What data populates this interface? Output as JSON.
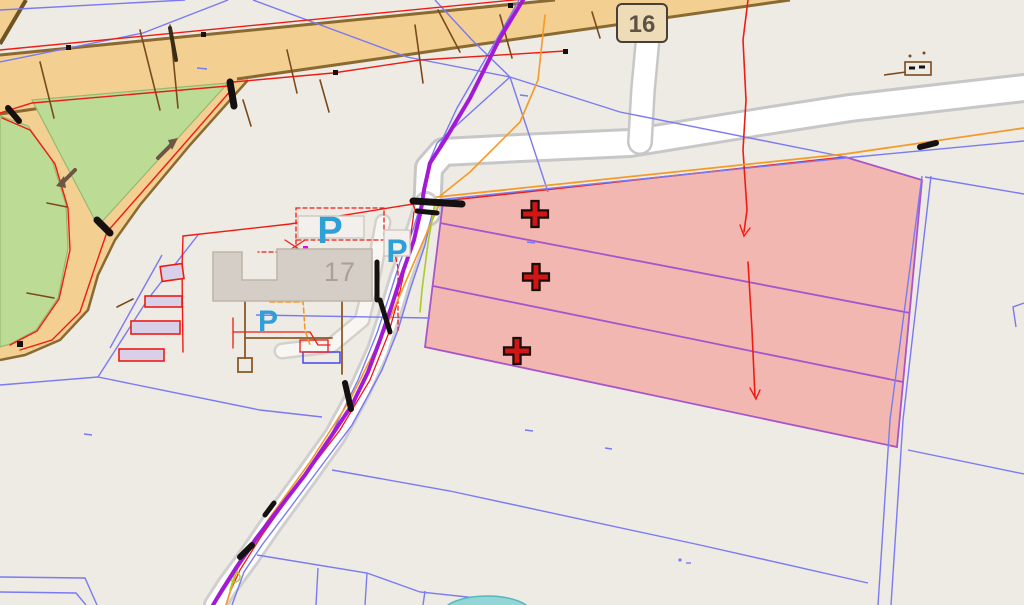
{
  "map": {
    "type": "cadastral-gis-map-viewport",
    "background": "#eeeae4",
    "labels": {
      "route_shield": "16",
      "building_number": "17",
      "parking": "P"
    },
    "crosses": [
      {
        "x": 535,
        "y": 214
      },
      {
        "x": 536,
        "y": 277
      },
      {
        "x": 517,
        "y": 351
      }
    ],
    "parking_markers": [
      {
        "x": 330,
        "y": 243,
        "size": 38
      },
      {
        "x": 397,
        "y": 262,
        "size": 32
      },
      {
        "x": 268,
        "y": 331,
        "size": 30
      }
    ],
    "colors": {
      "road_fill": "#f3cf92",
      "road_edge": "#8a6a30",
      "green_area": "#bcdc96",
      "parcel_highlight_fill": "#f3b7b1",
      "parcel_highlight_edge": "#a855cc",
      "parcel_line_blue": "#7a7af2",
      "utility_red": "#ee1c14",
      "utility_orange": "#f59a28",
      "pipeline_purple": "#a21ad6",
      "cross_marker": "#d01616",
      "parking_blue": "#2f9fd8",
      "water_teal": "#93d6d8",
      "building_fill": "#d5cec6",
      "building_small_fill": "#d8d0e8",
      "shield_fill": "#eedcb8",
      "white_road": "#ffffff"
    }
  }
}
